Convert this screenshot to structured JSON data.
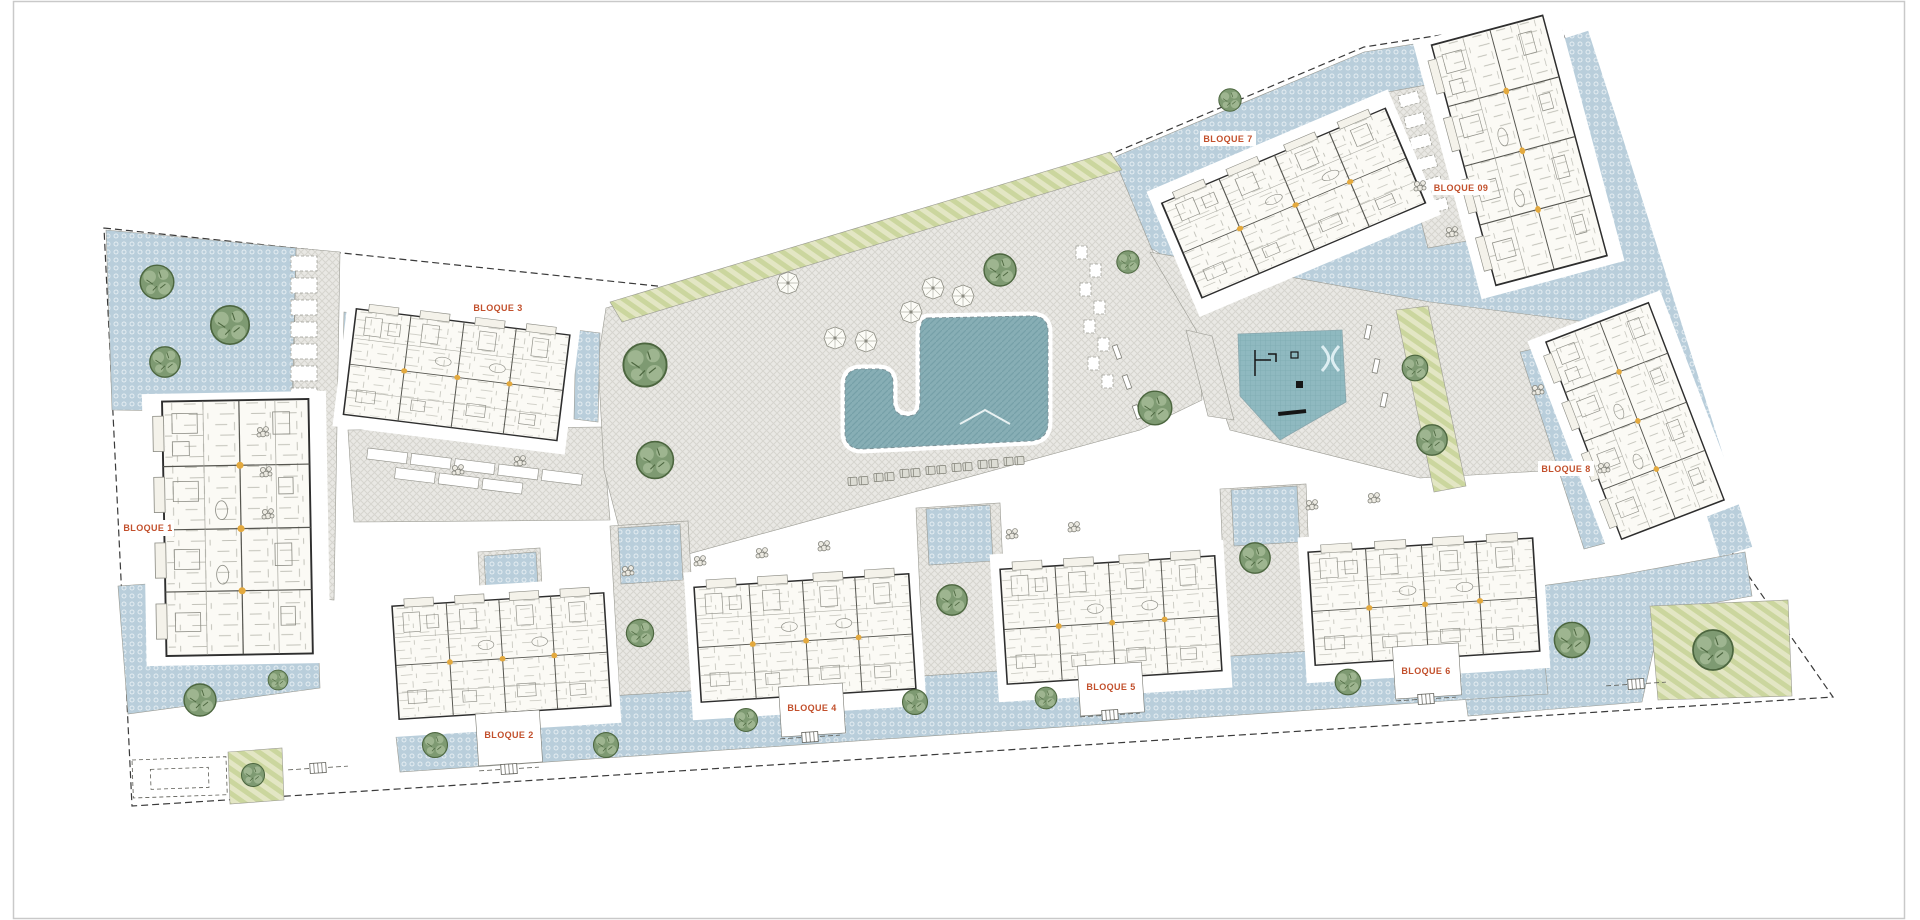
{
  "image": {
    "width": 1920,
    "height": 920,
    "background": "#ffffff",
    "frame_color": "#c9c9c9"
  },
  "plan": {
    "label_color": "#c2502c",
    "blocks": [
      {
        "id": "bloque-1",
        "label": "BLOQUE 1"
      },
      {
        "id": "bloque-2",
        "label": "BLOQUE 2"
      },
      {
        "id": "bloque-3",
        "label": "BLOQUE 3"
      },
      {
        "id": "bloque-4",
        "label": "BLOQUE 4"
      },
      {
        "id": "bloque-5",
        "label": "BLOQUE 5"
      },
      {
        "id": "bloque-6",
        "label": "BLOQUE 6"
      },
      {
        "id": "bloque-7",
        "label": "BLOQUE 7"
      },
      {
        "id": "bloque-8",
        "label": "BLOQUE 8"
      },
      {
        "id": "bloque-9",
        "label": "BLOQUE 09"
      }
    ],
    "colors": {
      "garden": "#b9cedb",
      "garden_dot": "#e4edf2",
      "paving": "#e9e8e4",
      "paving_line": "#d6d5cf",
      "pool": "#87aeb5",
      "pool_line": "#76a0a8",
      "playground": "#8fb9c0",
      "playground_line": "#7daab2",
      "lawn": "#e3e6c4",
      "lawn_stripe": "#cbd69e",
      "tree": "#7e9a72",
      "tree_dark": "#4c663f",
      "tree_light": "#a3ba95",
      "building": "#fbfaf5",
      "wall": "#2e2e2e",
      "door_accent": "#e3a93e",
      "boundary": "#3a3a3a"
    }
  }
}
